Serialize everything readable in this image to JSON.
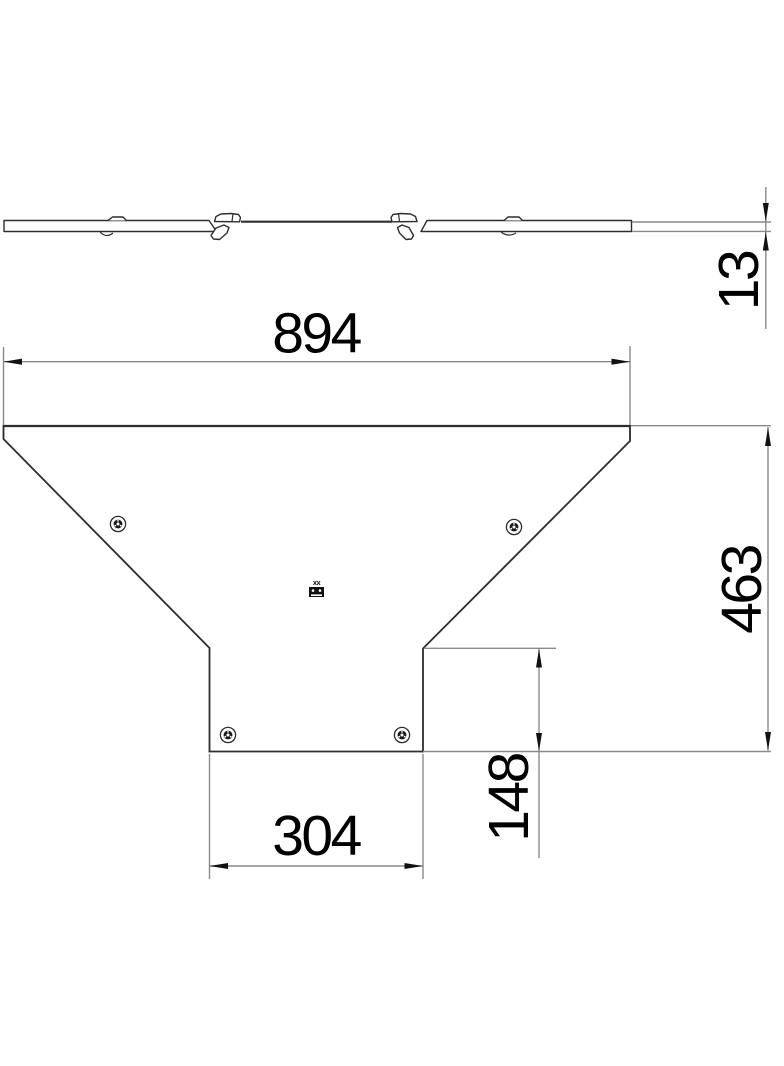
{
  "drawing": {
    "background": "#ffffff",
    "outline_color": "#2e2e2e",
    "dimension_line_color": "#8a8a8a",
    "text_color": "#000000",
    "dimensions": {
      "total_width": "894",
      "total_depth": "463",
      "branch_width": "304",
      "branch_offset": "148",
      "cover_height": "13"
    },
    "logo_text": "xx"
  }
}
